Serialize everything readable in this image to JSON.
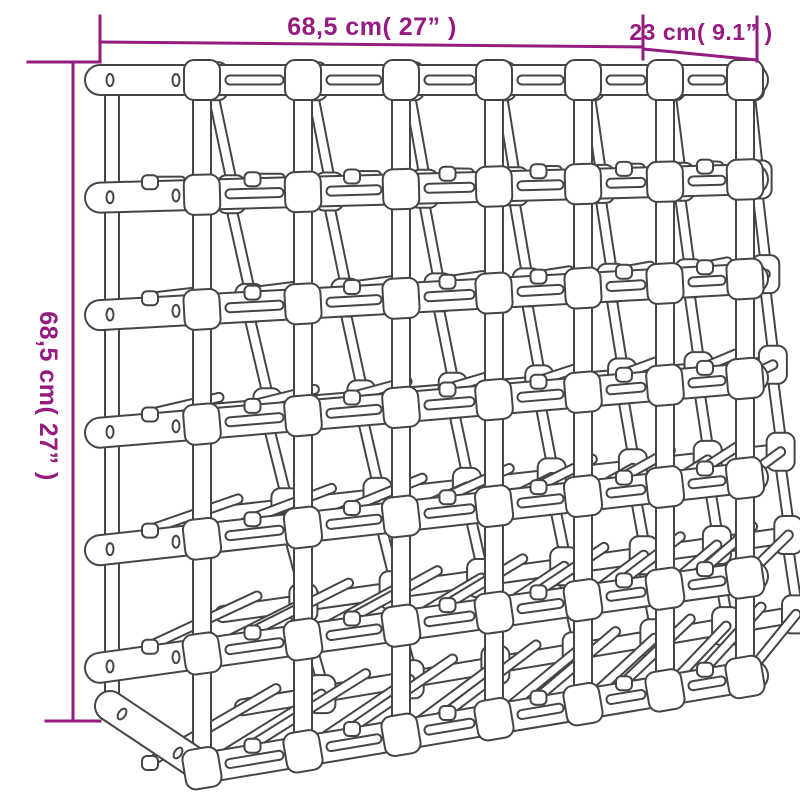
{
  "figure": {
    "type": "product dimension diagram",
    "subject": "wooden wine rack line drawing",
    "colors": {
      "dimension_accent": "#951b81",
      "drawing_outline": "#454545",
      "drawing_fill": "#ffffff",
      "background": "#ffffff"
    },
    "dimensions": {
      "width": {
        "label": "68,5 cm( 27” )",
        "value_cm": "68,5",
        "value_inch": "27”"
      },
      "depth": {
        "label": "23 cm( 9.1” )",
        "value_cm": "23",
        "value_inch": "9.1”"
      },
      "height": {
        "label": "68,5 cm( 27” )",
        "value_cm": "68,5",
        "value_inch": "27”"
      }
    },
    "rack": {
      "horizontal_rails": 7,
      "block_columns": 7,
      "bottle_columns": 7,
      "bottle_rows": 6
    }
  }
}
